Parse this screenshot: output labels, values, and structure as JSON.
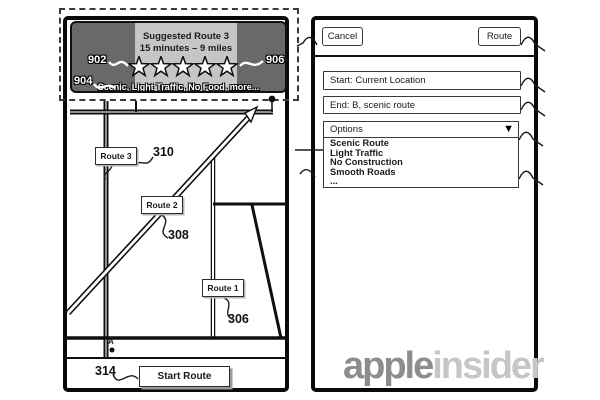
{
  "banner": {
    "title": "Suggested Route 3",
    "subtitle": "15 minutes – 9 miles",
    "stars": 5,
    "tags_prefix": "Scenic, Light Traffic, No Food, ",
    "more_label": "more...",
    "ref_left": "902",
    "ref_right": "906",
    "ref_bottom": "904"
  },
  "map": {
    "routes": [
      {
        "label": "Route 3",
        "ref": "310"
      },
      {
        "label": "Route 2",
        "ref": "308"
      },
      {
        "label": "Route 1",
        "ref": "306"
      }
    ],
    "start_point_label": "A",
    "start_ref": "314",
    "start_button_label": "Start Route"
  },
  "panel": {
    "cancel_label": "Cancel",
    "route_label": "Route",
    "start_field": "Start: Current Location",
    "end_field": "End: B, scenic route",
    "options_label": "Options",
    "dropdown_icon": "▼",
    "options": [
      "Scenic Route",
      "Light Traffic",
      "No Construction",
      "Smooth Roads",
      "..."
    ]
  },
  "watermark": {
    "bold": "apple",
    "light": "insider"
  },
  "colors": {
    "banner_dark": "#696969",
    "banner_light": "#c6c6c6",
    "road_gray": "#8f8f8f",
    "shadow_gray": "#9a9a9a",
    "logo_bold": "#8d8d8d",
    "logo_light": "#c6c6c6"
  }
}
